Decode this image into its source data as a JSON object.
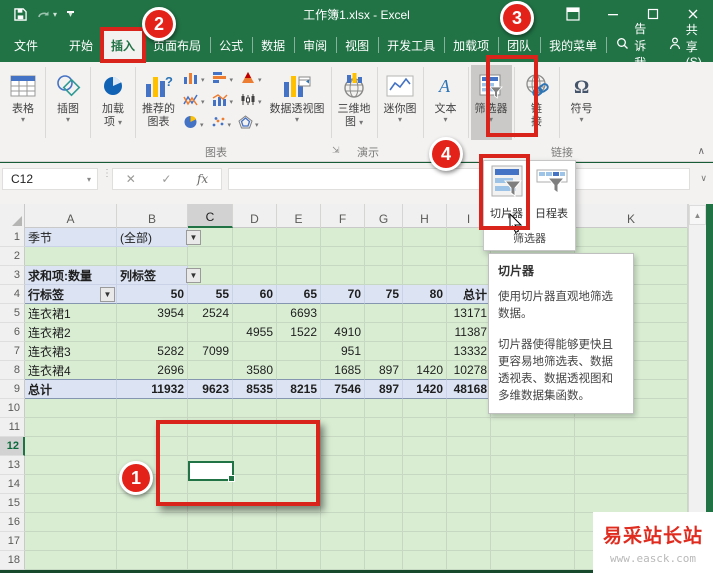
{
  "titlebar": {
    "title": "工作簿1.xlsx  -  Excel",
    "signin": "登录",
    "qat_icons": [
      "save-icon",
      "redo-icon",
      "customize-quick-access-icon"
    ],
    "window_icons": [
      "ribbon-display-options-icon",
      "minimize-icon",
      "maximize-icon",
      "close-icon"
    ]
  },
  "tabs": [
    {
      "label": "文件",
      "selected": false
    },
    {
      "label": "开始",
      "selected": false
    },
    {
      "label": "插入",
      "selected": true
    },
    {
      "label": "页面布局",
      "selected": false
    },
    {
      "label": "公式",
      "selected": false
    },
    {
      "label": "数据",
      "selected": false
    },
    {
      "label": "审阅",
      "selected": false
    },
    {
      "label": "视图",
      "selected": false
    },
    {
      "label": "开发工具",
      "selected": false
    },
    {
      "label": "加载项",
      "selected": false
    },
    {
      "label": "团队",
      "selected": false
    },
    {
      "label": "我的菜单",
      "selected": false
    }
  ],
  "tellme": "告诉我",
  "share": "共享(S)",
  "ribbon": {
    "buttons": {
      "tables": "表格",
      "illustrations": "插图",
      "addins1": "加载",
      "addins2": "项",
      "recommended1": "推荐的",
      "recommended2": "图表",
      "pivotchart": "数据透视图",
      "map3d1": "三维地",
      "map3d2": "图",
      "sparklines": "迷你图",
      "text": "文本",
      "filters": "筛选器",
      "link1": "链",
      "link2": "接",
      "symbols": "符号"
    },
    "groups": {
      "charts": "图表",
      "tours": "演示",
      "links": "链接"
    },
    "gallery_icons": [
      [
        "column-chart-icon",
        "stacked-bar-chart-icon",
        "hierarchy-chart-icon"
      ],
      [
        "line-chart-icon",
        "combo-chart-icon",
        "stock-chart-icon"
      ],
      [
        "pie-chart-icon",
        "scatter-chart-icon",
        "radar-chart-icon"
      ]
    ]
  },
  "formula_bar": {
    "name_box": "C12"
  },
  "sheet": {
    "columns": [
      "A",
      "B",
      "C",
      "D",
      "E",
      "F",
      "G",
      "H",
      "I",
      "J",
      "K"
    ],
    "selected_column": "C",
    "selected_row": 12,
    "row_count": 18,
    "pivot": {
      "filter_label": "季节",
      "filter_value": "(全部)",
      "measure": "求和项:数量",
      "col_header_label": "列标签",
      "row_header_label": "行标签",
      "columns": [
        "50",
        "55",
        "60",
        "65",
        "70",
        "75",
        "80",
        "总计"
      ],
      "rows": [
        {
          "label": "连衣裙1",
          "values": [
            "3954",
            "2524",
            "",
            "6693",
            "",
            "",
            "",
            "13171"
          ]
        },
        {
          "label": "连衣裙2",
          "values": [
            "",
            "",
            "4955",
            "1522",
            "4910",
            "",
            "",
            "11387"
          ]
        },
        {
          "label": "连衣裙3",
          "values": [
            "5282",
            "7099",
            "",
            "",
            "951",
            "",
            "",
            "13332"
          ]
        },
        {
          "label": "连衣裙4",
          "values": [
            "2696",
            "",
            "3580",
            "",
            "1685",
            "897",
            "1420",
            "10278"
          ]
        }
      ],
      "total_row": {
        "label": "总计",
        "values": [
          "11932",
          "9623",
          "8535",
          "8215",
          "7546",
          "897",
          "1420",
          "48168"
        ]
      }
    }
  },
  "flyout": {
    "items": [
      {
        "label": "切片器",
        "icon": "slicer-icon"
      },
      {
        "label": "日程表",
        "icon": "timeline-icon"
      }
    ],
    "footer": "筛选器"
  },
  "tooltip": {
    "title": "切片器",
    "body1": "使用切片器直观地筛选数据。",
    "body2": "切片器使得能够更快且更容易地筛选表、数据透视表、数据透视图和多维数据集函数。"
  },
  "annotations": {
    "badge1": "1",
    "badge2": "2",
    "badge3": "3",
    "badge4": "4"
  },
  "watermark": {
    "name": "易采站长站",
    "url": "www.easck.com"
  },
  "colors": {
    "excel_green": "#217346",
    "annotation_red": "#e32219",
    "pivot_header_fill": "#dce4f3",
    "sheet_fill": "#d9edd3"
  }
}
